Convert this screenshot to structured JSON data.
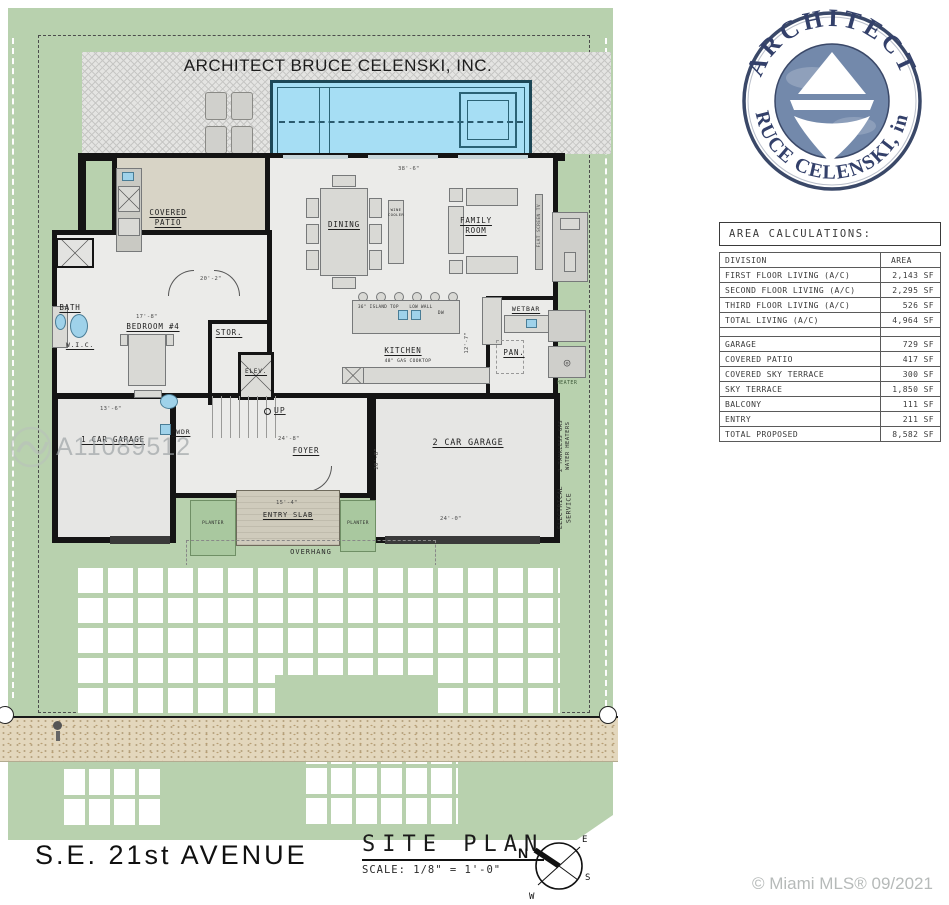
{
  "banner": "ARCHITECT BRUCE CELENSKI, INC.",
  "logo": {
    "top_text": "ARCHITECT",
    "bottom_text": "BRUCE CELENSKI, inc.",
    "ring_color": "#3a4868",
    "center_color": "#7389ab"
  },
  "area_table": {
    "title": "AREA CALCULATIONS:",
    "header": [
      "DIVISION",
      "AREA"
    ],
    "rows": [
      [
        "FIRST FLOOR LIVING (A/C)",
        "2,143 SF"
      ],
      [
        "SECOND FLOOR LIVING (A/C)",
        "2,295 SF"
      ],
      [
        "THIRD FLOOR LIVING (A/C)",
        "526 SF"
      ],
      [
        "TOTAL LIVING (A/C)",
        "4,964 SF"
      ],
      [
        "",
        ""
      ],
      [
        "GARAGE",
        "729 SF"
      ],
      [
        "COVERED PATIO",
        "417 SF"
      ],
      [
        "COVERED SKY TERRACE",
        "300 SF"
      ],
      [
        "SKY TERRACE",
        "1,850 SF"
      ],
      [
        "BALCONY",
        "111 SF"
      ],
      [
        "ENTRY",
        "211 SF"
      ],
      [
        "TOTAL PROPOSED",
        "8,582 SF"
      ]
    ]
  },
  "plan": {
    "rooms": {
      "covered_patio": "COVERED\nPATIO",
      "dining": "DINING",
      "family_room": "FAMILY\nROOM",
      "kitchen": "KITCHEN",
      "wetbar": "WETBAR",
      "pantry": "PAN.",
      "bath": "BATH",
      "bedroom4": "BEDROOM #4",
      "wic": "W.I.C.",
      "storage": "STOR.",
      "elevator": "ELEV.",
      "powder": "PWDR",
      "foyer": "FOYER",
      "garage1": "1 CAR GARAGE",
      "garage2": "2 CAR GARAGE",
      "entry_slab": "ENTRY SLAB"
    },
    "site_labels": {
      "overhang": "OVERHANG",
      "planter": "PLANTER",
      "heater": "HEATER",
      "up": "UP",
      "tankless": "2 TANKLESS GAS\nWATER HEATERS",
      "electrical": "ELECTRICAL\nSERVICE",
      "flat_tv": "FLAT SCREEN TV",
      "wine_cooler": "WINE\nCOOLER",
      "island_note": "36\" ISLAND TOP",
      "low_wall": "LOW WALL",
      "dw": "DW",
      "cooktop": "48\" GAS COOKTOP"
    },
    "dims": [
      "38'-6\"",
      "20'-2\"",
      "17'-8\"",
      "13'-6\"",
      "24'-8\"",
      "20'-8\"",
      "24'-0\"",
      "15'-4\"",
      "12'-7\""
    ]
  },
  "titleblock": {
    "title": "SITE PLAN",
    "scale": "SCALE: 1/8\" = 1'-0\""
  },
  "street_label": "S.E. 21st AVENUE",
  "compass": {
    "n": "N",
    "e": "E",
    "s": "S",
    "w": "W"
  },
  "watermarks": {
    "mls_number": "A11089512",
    "credit": "© Miami MLS® 09/2021"
  },
  "colors": {
    "lawn": "#b8d1ae",
    "pool": "#a6def4",
    "deck": "#e4e4e2",
    "patio_floor": "#d8d4c6",
    "interior_floor": "#ebebe9",
    "wall": "#141414",
    "swale": "#e3d7bd",
    "logo_blue": "#7389ab"
  }
}
